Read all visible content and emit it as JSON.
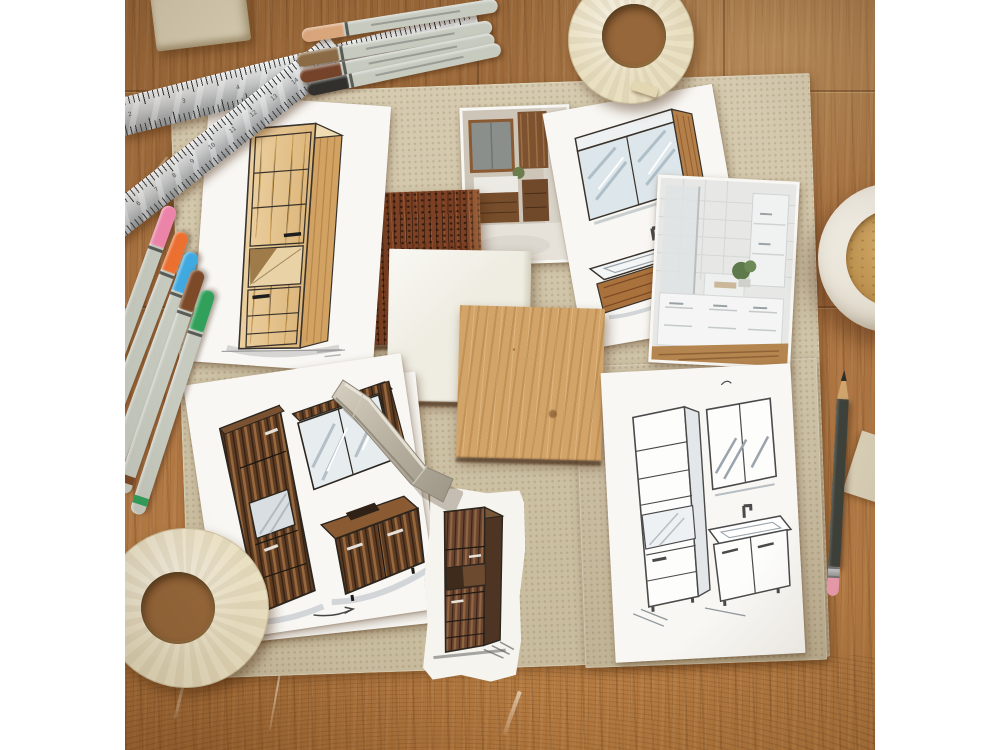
{
  "photo": {
    "alt": "Flat-lay photograph of a bathroom furniture design moodboard: marker sketches of cabinets, washbasins and mirror cabinets, wood material samples, printed bathroom photos, rulers, markers, masking tape, a furniture handle, a pencil and a cup of coffee on a worn wooden workbench"
  },
  "items": [
    {
      "name": "wooden-workbench",
      "description": "Worn oak workbench with scratches and saw marks"
    },
    {
      "name": "moodboard-cardboard",
      "description": "Large beige cardboard moodboard"
    },
    {
      "name": "sketch-pine-tall-cabinet",
      "description": "Marker sketch of a light pine tall bathroom cabinet"
    },
    {
      "name": "sketch-mirror-washbasin",
      "description": "Marker sketch of a mirror cabinet and washbasin with wood apron"
    },
    {
      "name": "sketch-rustic-set",
      "description": "Marker sketch of rustic dark-wood bathroom set: tall cabinet, mirror, vanity"
    },
    {
      "name": "sketch-line-set",
      "description": "Pencil line sketch of tall cabinet, mirror cabinet and vanity unit"
    },
    {
      "name": "sketch-walnut-cabinet",
      "description": "Torn paper strip with walnut tall cabinet sketch"
    },
    {
      "name": "photo-rustic-bathroom",
      "description": "Printed photo of bathroom with rustic wood furniture"
    },
    {
      "name": "photo-white-bathroom",
      "description": "Printed photo of white bathroom furniture"
    },
    {
      "name": "sample-rust-wood",
      "description": "Aged rust-brown wood material sample"
    },
    {
      "name": "sample-cream",
      "description": "Cream laminate material sample"
    },
    {
      "name": "sample-oak",
      "description": "Light oak wood material sample"
    },
    {
      "name": "steel-rulers",
      "description": "Two crossed stainless steel rulers"
    },
    {
      "name": "brown-markers",
      "description": "Four brown-tone sketch markers"
    },
    {
      "name": "color-markers",
      "description": "Five colored sketch markers: pink, orange, blue, brown, green"
    },
    {
      "name": "masking-tape",
      "description": "Two rolls of cream masking tape"
    },
    {
      "name": "furniture-handle",
      "description": "Champagne metal furniture bow handle"
    },
    {
      "name": "coffee-cup",
      "description": "White ceramic cup with milky coffee"
    },
    {
      "name": "pencil",
      "description": "Dark pencil with pink eraser"
    },
    {
      "name": "eraser-block",
      "description": "Beige eraser block"
    },
    {
      "name": "paper-corner",
      "description": "Beige paper corner at right edge"
    }
  ],
  "palette": {
    "margin": "#ffffff",
    "table": "#aa7240",
    "board": "#d1c5a7",
    "board2": "#c9bc9e",
    "paper": "#f8f7f3",
    "torn_paper": "#f5f4ef",
    "steel": "#c9cacb",
    "eraser_block": "#d7cdb3",
    "tape": "#e9dfc1",
    "tape_core": "#96673a",
    "marker_body": "#c6cabf",
    "brown_caps": [
      "#d9a57b",
      "#8a6b45",
      "#74432a",
      "#32302c"
    ],
    "color_caps": [
      "#ef86ac",
      "#ec7030",
      "#3fa9e0",
      "#7c4a28",
      "#31a05a"
    ],
    "pine": "#e5c28d",
    "rustic": "#5d3b24",
    "walnut": "#6b4530",
    "oak": "#d2a468",
    "rust": "#7c4124",
    "cream": "#efede2",
    "handle_metal": "#c0b9a9",
    "coffee": "#c2945a",
    "cup": "#f2eee5",
    "pencil_body": "#3d423b",
    "pencil_eraser": "#ef9fb0",
    "corner_paper": "#dcd3ba"
  },
  "rulers": {
    "a_numbers": [
      "2",
      "3",
      "4",
      "5",
      "6",
      "7",
      "8"
    ],
    "b_numbers": [
      "4",
      "5",
      "6",
      "7",
      "8",
      "9",
      "10",
      "11",
      "12",
      "13",
      "14",
      "15"
    ]
  }
}
